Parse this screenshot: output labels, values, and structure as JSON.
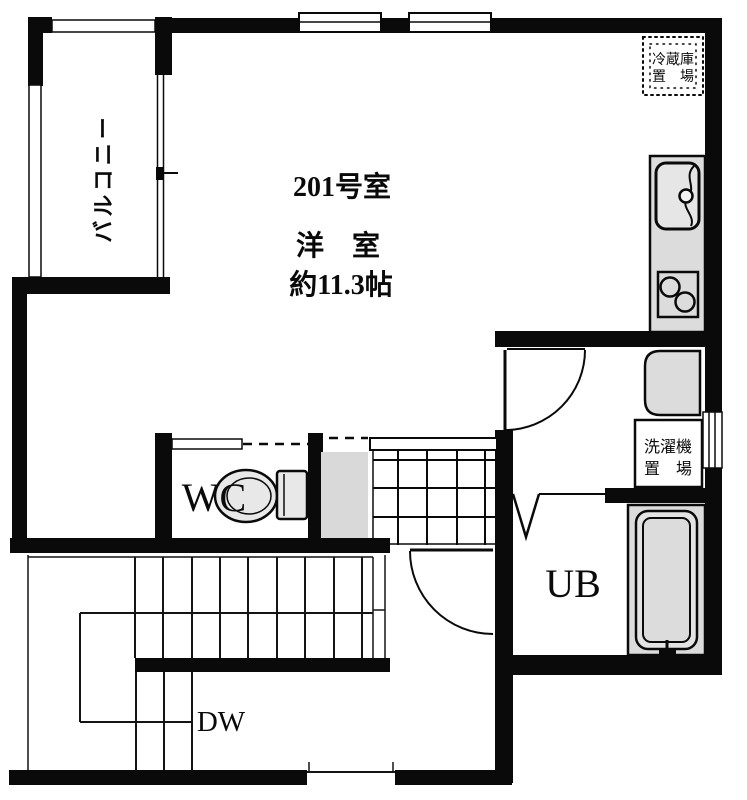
{
  "plan": {
    "unit_title": "201号室",
    "main_room": {
      "name": "洋　室",
      "area": "約11.3帖"
    },
    "balcony_label": "バルコニー",
    "wc_label": "WC",
    "ub_label": "UB",
    "dw_label": "DW",
    "refrigerator_space": {
      "line1": "冷蔵庫",
      "line2": "置　場"
    },
    "washing_machine_space": {
      "line1": "洗濯機",
      "line2": "置　場"
    },
    "colors": {
      "wall": "#000000",
      "fixture_fill": "#dcdcdc",
      "background": "#ffffff"
    }
  }
}
